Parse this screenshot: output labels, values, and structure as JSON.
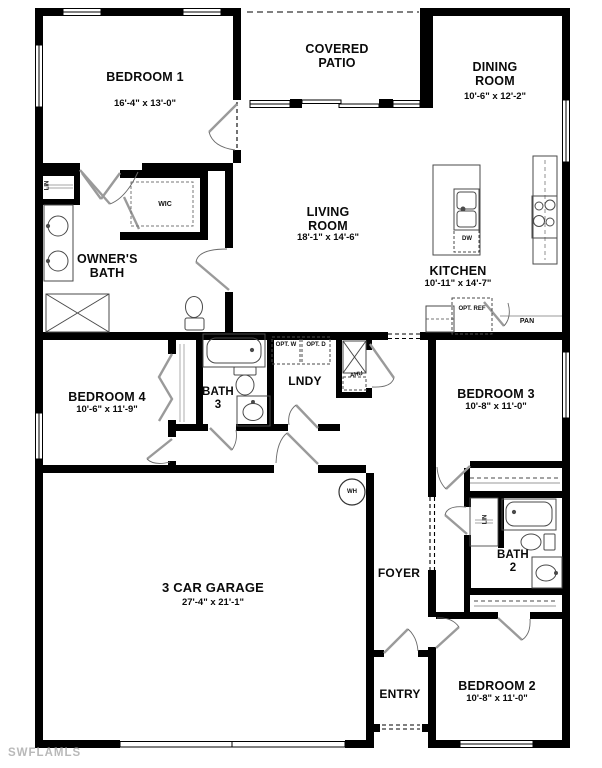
{
  "watermark": "SWFLAMLS",
  "rooms": {
    "bedroom1": {
      "name": "BEDROOM 1",
      "dims": "16'-4\" x 13'-0\""
    },
    "covered_patio": {
      "name": "COVERED PATIO"
    },
    "dining": {
      "name": "DINING ROOM",
      "dims": "10'-6\" x 12'-2\""
    },
    "living": {
      "name": "LIVING ROOM",
      "dims": "18'-1\" x 14'-6\""
    },
    "owners_bath": {
      "name": "OWNER'S BATH"
    },
    "kitchen": {
      "name": "KITCHEN",
      "dims": "10'-11\" x 14'-7\""
    },
    "bedroom4": {
      "name": "BEDROOM 4",
      "dims": "10'-6\" x 11'-9\""
    },
    "bath3": {
      "name": "BATH 3"
    },
    "lndy": {
      "name": "LNDY"
    },
    "bedroom3": {
      "name": "BEDROOM 3",
      "dims": "10'-8\" x 11'-0\""
    },
    "bath2": {
      "name": "BATH 2"
    },
    "garage": {
      "name": "3 CAR GARAGE",
      "dims": "27'-4\" x 21'-1\""
    },
    "foyer": {
      "name": "FOYER"
    },
    "entry": {
      "name": "ENTRY"
    },
    "bedroom2": {
      "name": "BEDROOM 2",
      "dims": "10'-8\" x 11'-0\""
    }
  },
  "fixtures": {
    "wic": "WIC",
    "lin": "LIN",
    "dw": "DW",
    "opt_ref": "OPT. REF",
    "pan": "PAN",
    "opt_w": "OPT. W",
    "opt_d": "OPT. D",
    "ahu": "AHU",
    "wh": "WH"
  },
  "colors": {
    "wall": "#000000",
    "fixture_line": "#4a4a4a",
    "door_panel": "#9a9a9a",
    "watermark": "#b9b9b9",
    "background": "#ffffff"
  }
}
